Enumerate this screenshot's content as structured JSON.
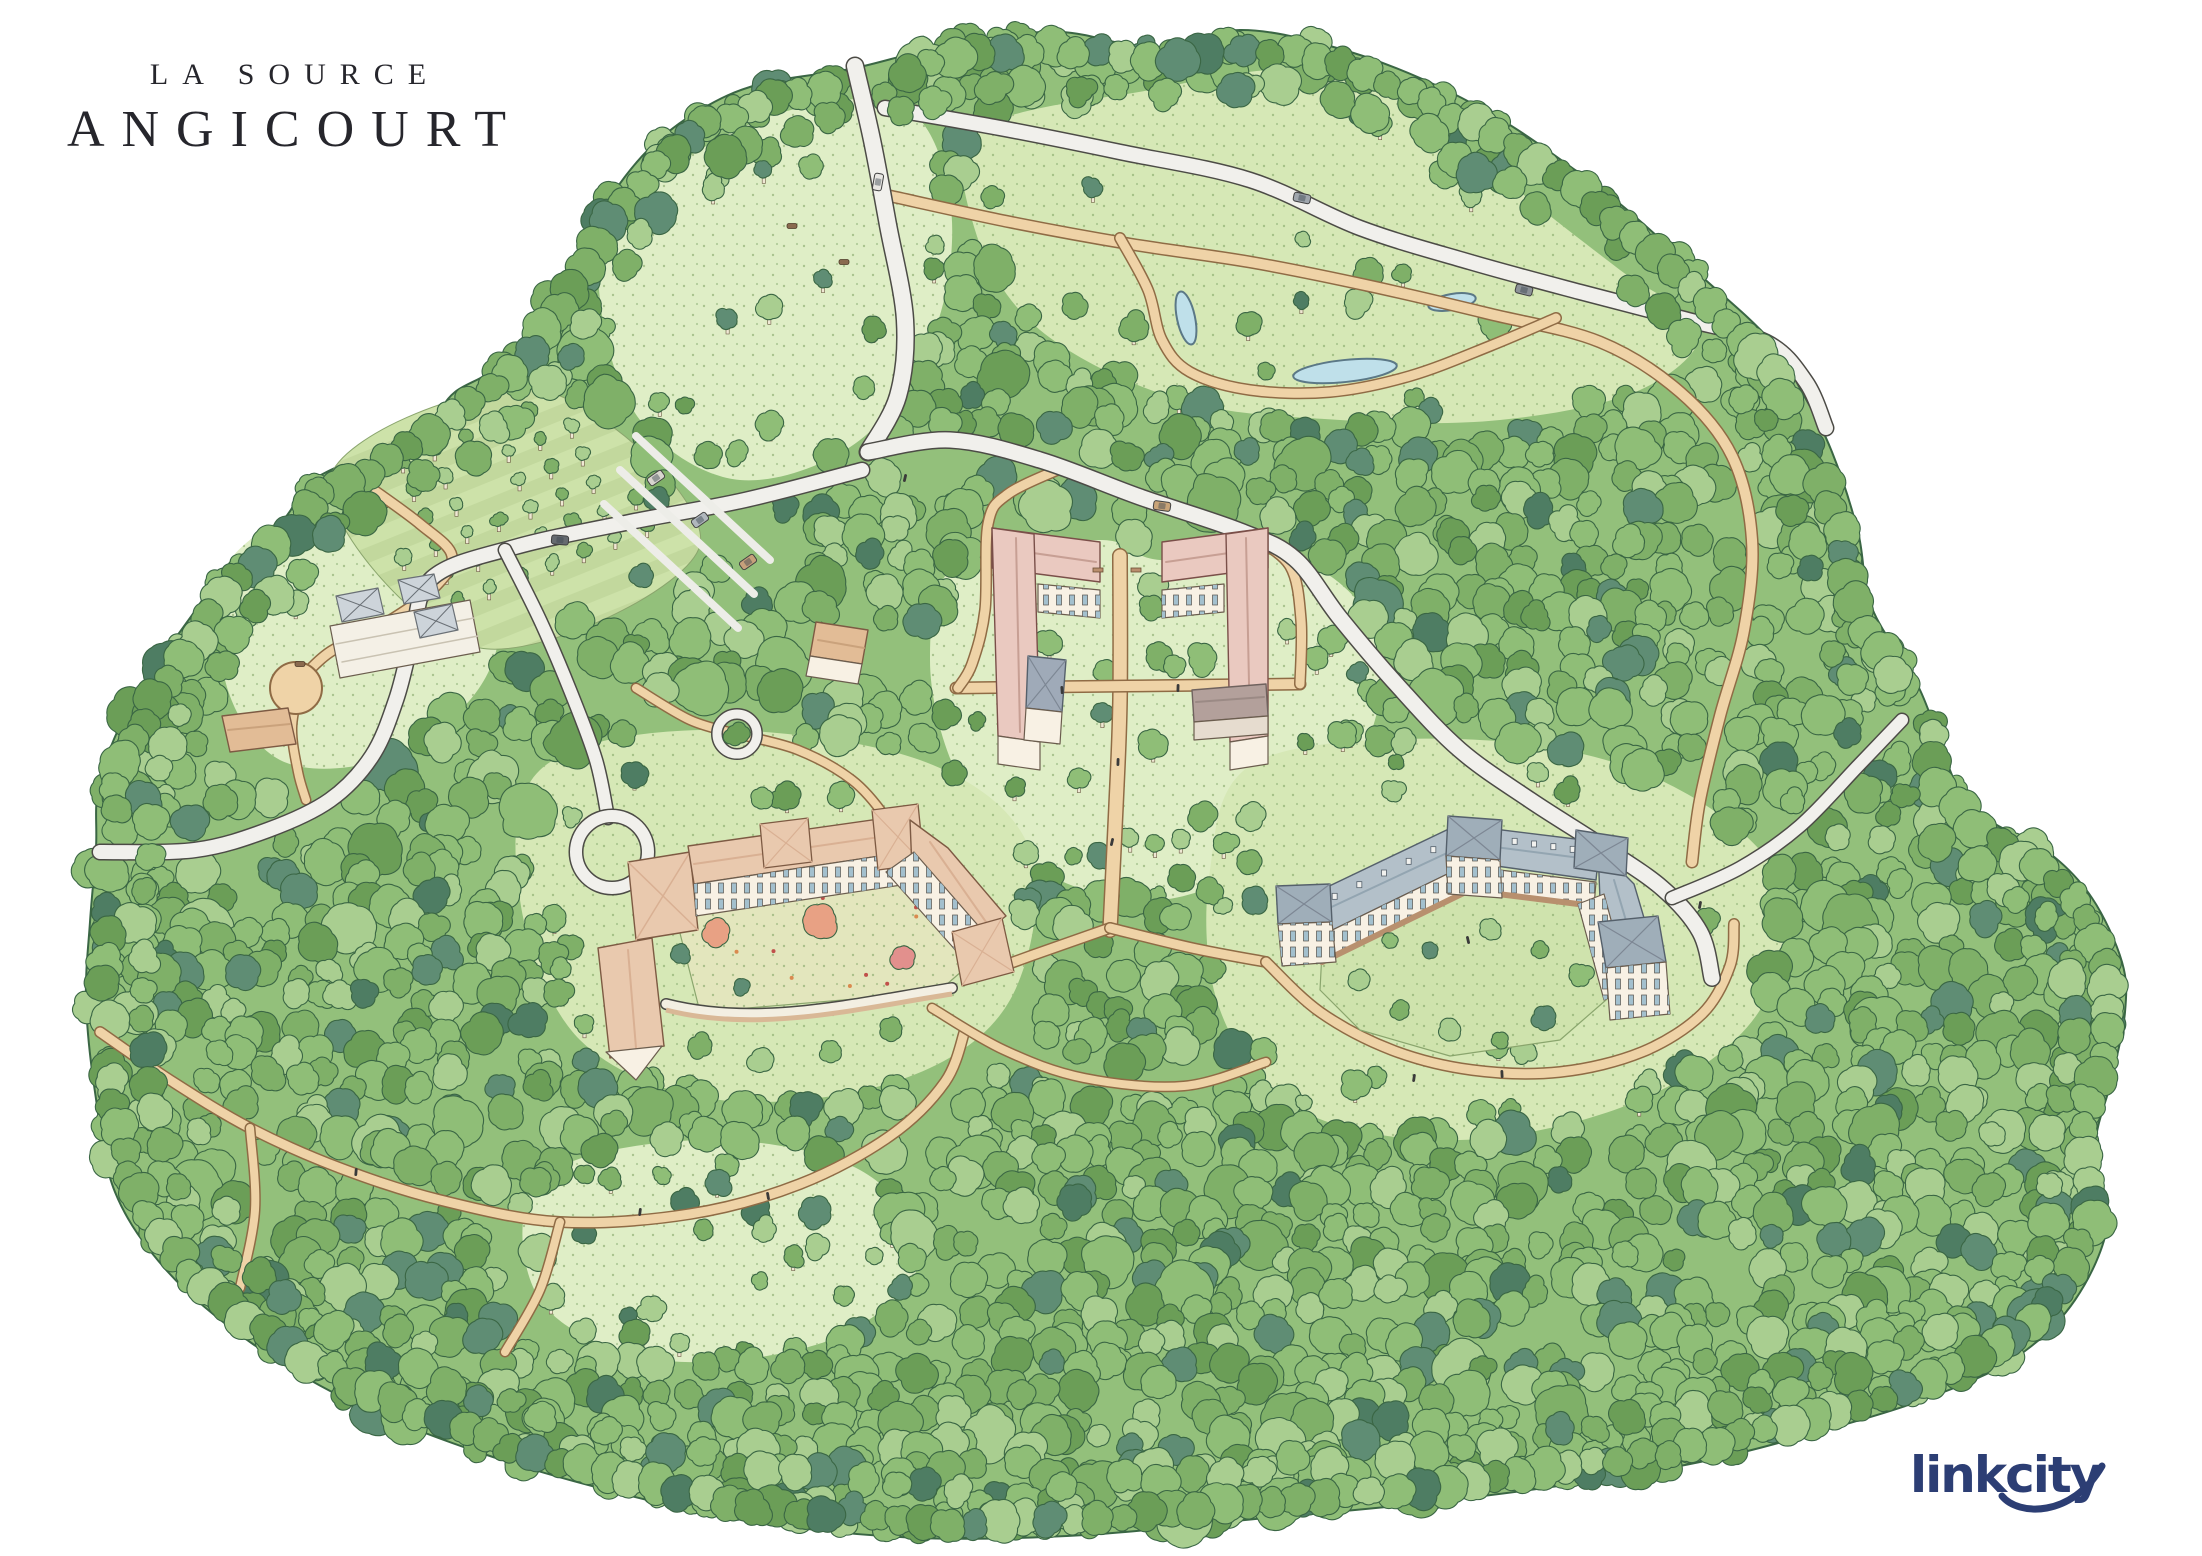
{
  "title": {
    "line1": "LA SOURCE",
    "line2": "ANGICOURT"
  },
  "logo": {
    "text": "linkcity"
  },
  "palette": {
    "background": "#FFFFFF",
    "forest_base": "#93C07B",
    "forest_outline": "#3A6644",
    "tree_greens": [
      "#A9CE90",
      "#8FBE77",
      "#7FB068",
      "#6B9E57",
      "#5F8D74",
      "#4E7D63"
    ],
    "lawn": "#D6E8B6",
    "lawn_light": "#DFEEC6",
    "road_fill": "#F1F0EC",
    "road_casing": "#4C4B46",
    "path_fill": "#EFD3A7",
    "path_casing": "#8F6B45",
    "pond": "#BFE0EA",
    "pond_casing": "#5B7886",
    "roof_pink": "#EAC9C0",
    "roof_salmon": "#E9C9AE",
    "roof_slate": "#B3C0C9",
    "roof_mauve": "#B3A09B",
    "roof_tan": "#E2BC96",
    "facade": "#F8F1E4",
    "window": "#A3C0CE",
    "arcade": "#B8906E",
    "autumn_coral": "#E8A184",
    "autumn_red": "#E2908D",
    "title_color": "#26262C",
    "logo_navy": "#2C3E74"
  },
  "map_features": [
    "north-entrance-road",
    "upper-meadow",
    "great-lawn",
    "pond",
    "orchard",
    "parking-grove",
    "farm-greenhouses",
    "garden-shed",
    "twin-gabled-residences",
    "chapel",
    "barn",
    "courtyard-residence-west",
    "crescent-residence-east",
    "central-axis-path",
    "forest-trails",
    "roundabout-grove"
  ]
}
